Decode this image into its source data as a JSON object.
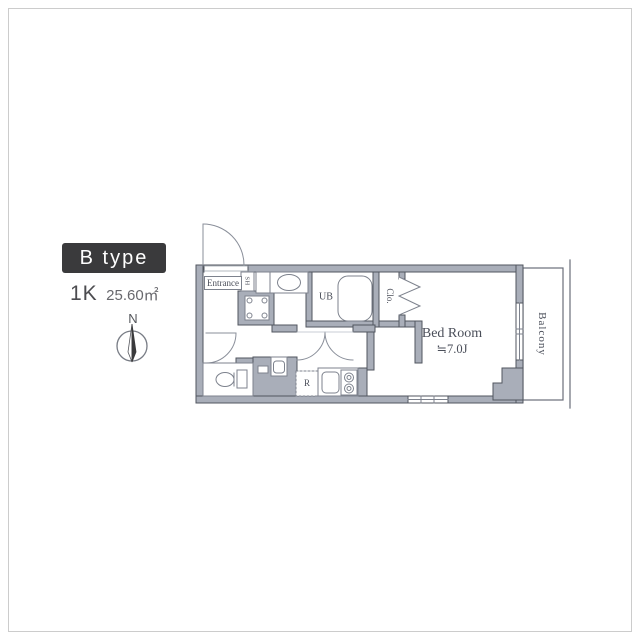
{
  "legend": {
    "type_label": "B type",
    "layout": "1K",
    "area": "25.60㎡",
    "compass_north": "N"
  },
  "floor_plan": {
    "rooms": {
      "entrance": "Entrance",
      "shoe_cabinet": "SH",
      "unit_bath": "UB",
      "closet": "Clo.",
      "bedroom_name": "Bed Room",
      "bedroom_size": "≒7.0J",
      "balcony": "Balcony",
      "refrigerator": "R"
    },
    "colors": {
      "wall_fill": "#a9aeb9",
      "wall_line": "#51565f",
      "fixture_line": "#7d828d",
      "text": "#4a4e59",
      "badge_bg": "#3a3a3c",
      "badge_text": "#ffffff"
    }
  }
}
